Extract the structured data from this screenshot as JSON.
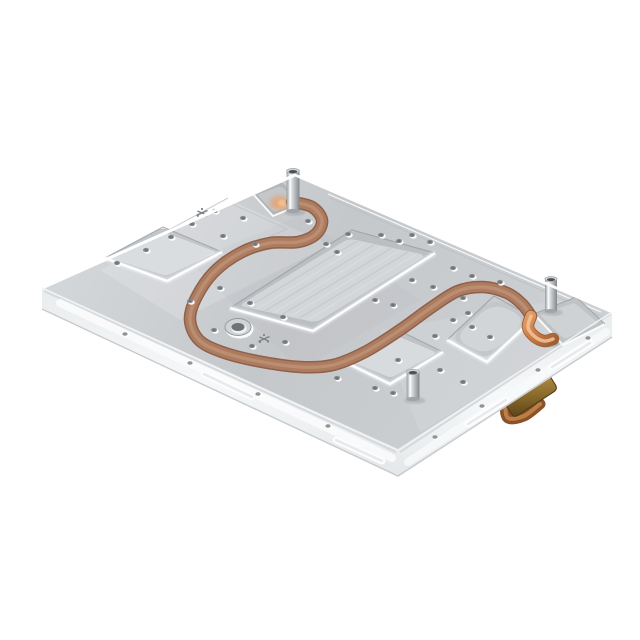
{
  "meta": {
    "type": "product-photograph",
    "subject": "CNC machined aluminum liquid cold plate with embedded serpentine copper tube",
    "background_color": "#ffffff"
  },
  "palette": {
    "bg": "#ffffff",
    "plate_light": "#d6d9dc",
    "plate_mid": "#c6c9cc",
    "plate_edge_hi": "#ffffff",
    "pocket_wall": "#b7bbbe",
    "pocket_floor": "#d7dadc",
    "pocket_rim_dark": "#9ba0a4",
    "wall_light": "#f2f4f5",
    "wall_mid": "#e6e9ea",
    "wall_line": "#cfd3d5",
    "copper_edge": "#8f604a",
    "copper_mid": "#ab7c60",
    "copper_hi": "#c met"
  },
  "palette_fix": {
    "copper_hi": "#c09175",
    "copper_bright": "#cf8048",
    "copper_glow": "#f0b483",
    "brass_dark": "#5e4619",
    "brass_mid": "#9a7b3a",
    "brass_light": "#c4a05c",
    "steel_dark": "#8f9396",
    "steel_light": "#eef0f1",
    "hole_dark": "#878c90",
    "hole_core": "#6f7478",
    "shadow": "#8d9296"
  },
  "scene": {
    "canvas": {
      "w": 640,
      "h": 640
    },
    "plate": {
      "top": [
        [
          42,
          288
        ],
        [
          295,
          175
        ],
        [
          612,
          312
        ],
        [
          398,
          450
        ]
      ],
      "left_wall": [
        [
          42,
          288
        ],
        [
          398,
          450
        ],
        [
          398,
          477
        ],
        [
          42,
          309
        ]
      ],
      "right_wall": [
        [
          398,
          450
        ],
        [
          612,
          312
        ],
        [
          612,
          338
        ],
        [
          398,
          477
        ]
      ]
    },
    "sheens": [
      {
        "pts": [
          [
            100,
            270
          ],
          [
            230,
            200
          ],
          [
            330,
            245
          ],
          [
            180,
            320
          ]
        ],
        "fill": "#ffffff",
        "op": 0.16
      },
      {
        "pts": [
          [
            380,
            330
          ],
          [
            560,
            300
          ],
          [
            600,
            322
          ],
          [
            420,
            432
          ]
        ],
        "fill": "#ffffff",
        "op": 0.1
      },
      {
        "pts": [
          [
            190,
            262
          ],
          [
            300,
            216
          ],
          [
            420,
            300
          ],
          [
            300,
            370
          ]
        ],
        "fill": "#9aa0a5",
        "op": 0.07
      }
    ],
    "pockets": {
      "left": {
        "quad": [
          [
            105,
            258
          ],
          [
            163,
            227
          ],
          [
            222,
            252
          ],
          [
            167,
            281
          ]
        ],
        "r": 7,
        "inset": 5
      },
      "center": {
        "quad": [
          [
            230,
            308
          ],
          [
            352,
            230
          ],
          [
            435,
            253
          ],
          [
            313,
            331
          ]
        ],
        "r": 10,
        "inset": 9,
        "brush": 8
      },
      "small": {
        "quad": [
          [
            345,
            362
          ],
          [
            398,
            330
          ],
          [
            443,
            352
          ],
          [
            390,
            384
          ]
        ],
        "r": 8,
        "inset": 6
      },
      "round_right": {
        "quad": [
          [
            447,
            340
          ],
          [
            494,
            296
          ],
          [
            534,
            318
          ],
          [
            487,
            362
          ]
        ],
        "r": 21,
        "inset": 6
      }
    },
    "notch_top": {
      "quad": [
        [
          253,
          194
        ],
        [
          282,
          182
        ],
        [
          302,
          204
        ],
        [
          273,
          216
        ]
      ],
      "glow": [
        280,
        203
      ]
    },
    "corner_cutout": {
      "quad": [
        [
          534,
          314
        ],
        [
          576,
          297
        ],
        [
          605,
          324
        ],
        [
          563,
          345
        ]
      ]
    },
    "tube": {
      "width": 10.5,
      "path": [
        [
          292,
          202
        ],
        [
          312,
          207
        ],
        [
          322,
          220
        ],
        [
          316,
          234
        ],
        [
          298,
          242
        ],
        [
          270,
          243
        ],
        [
          242,
          252
        ],
        [
          214,
          272
        ],
        [
          196,
          298
        ],
        [
          190,
          320
        ],
        [
          199,
          340
        ],
        [
          222,
          352
        ],
        [
          257,
          361
        ],
        [
          300,
          367
        ],
        [
          333,
          365
        ],
        [
          365,
          352
        ],
        [
          400,
          330
        ],
        [
          432,
          307
        ],
        [
          458,
          291
        ],
        [
          483,
          287
        ],
        [
          507,
          293
        ],
        [
          522,
          304
        ],
        [
          531,
          316
        ]
      ],
      "elbow": [
        [
          531,
          316
        ],
        [
          528,
          327
        ],
        [
          534,
          336
        ],
        [
          544,
          341
        ],
        [
          553,
          339
        ]
      ]
    },
    "counterbore": {
      "cx": 238,
      "cy": 327,
      "rx": 13,
      "ry": 8.5,
      "hole_rx": 6.5,
      "hole_ry": 4
    },
    "fiducials": [
      [
        202,
        213
      ],
      [
        264,
        339
      ]
    ],
    "standoffs": [
      {
        "x": 293,
        "top": 171,
        "h": 40,
        "w": 13
      },
      {
        "x": 551,
        "top": 279,
        "h": 32,
        "w": 12
      },
      {
        "x": 413,
        "top": 372,
        "h": 27,
        "w": 13
      }
    ],
    "holes": [
      [
        215,
        211
      ],
      [
        243,
        218
      ],
      [
        192,
        224
      ],
      [
        171,
        237
      ],
      [
        146,
        250
      ],
      [
        117,
        263
      ],
      [
        223,
        236
      ],
      [
        255,
        244
      ],
      [
        308,
        221
      ],
      [
        326,
        244
      ],
      [
        337,
        252
      ],
      [
        348,
        234
      ],
      [
        220,
        288
      ],
      [
        190,
        301
      ],
      [
        250,
        303
      ],
      [
        283,
        317
      ],
      [
        214,
        330
      ],
      [
        252,
        346
      ],
      [
        285,
        342
      ],
      [
        381,
        235
      ],
      [
        399,
        241
      ],
      [
        412,
        235
      ],
      [
        430,
        242
      ],
      [
        453,
        268
      ],
      [
        472,
        276
      ],
      [
        500,
        282
      ],
      [
        412,
        280
      ],
      [
        433,
        287
      ],
      [
        463,
        298
      ],
      [
        453,
        320
      ],
      [
        472,
        327
      ],
      [
        435,
        336
      ],
      [
        375,
        300
      ],
      [
        393,
        305
      ],
      [
        398,
        360
      ],
      [
        337,
        378
      ],
      [
        375,
        388
      ],
      [
        393,
        393
      ],
      [
        440,
        370
      ],
      [
        463,
        382
      ],
      [
        468,
        313
      ],
      [
        490,
        337
      ]
    ],
    "wall_holes_left": [
      [
        125,
        334
      ],
      [
        190,
        363
      ],
      [
        258,
        394
      ],
      [
        328,
        426
      ]
    ],
    "wall_holes_right": [
      [
        435,
        437
      ],
      [
        482,
        406
      ],
      [
        538,
        370
      ],
      [
        588,
        338
      ]
    ],
    "wall_slots": [
      [
        [
          204,
          374
        ],
        [
          252,
          397
        ]
      ],
      [
        [
          336,
          440
        ],
        [
          382,
          461
        ]
      ],
      [
        [
          468,
          424
        ],
        [
          506,
          400
        ]
      ],
      [
        [
          552,
          367
        ],
        [
          590,
          343
        ]
      ]
    ],
    "wall_bands": {
      "left_hi": [
        [
          60,
          303
        ],
        [
          392,
          458
        ]
      ],
      "right_hi": [
        [
          408,
          462
        ],
        [
          606,
          332
        ]
      ],
      "left_top_dark": [
        [
          44,
          291
        ],
        [
          396,
          452
        ]
      ],
      "right_top_dark": [
        [
          400,
          452
        ],
        [
          610,
          314
        ]
      ],
      "left_bottom": [
        [
          42,
          309
        ],
        [
          398,
          476
        ]
      ],
      "right_bottom": [
        [
          398,
          476
        ],
        [
          612,
          337
        ]
      ]
    },
    "steps": {
      "lineA": [
        [
          128,
          252
        ],
        [
          228,
          198
        ]
      ],
      "quadB": [
        [
          168,
          231
        ],
        [
          232,
          204
        ],
        [
          287,
          229
        ],
        [
          223,
          257
        ]
      ],
      "rim": [
        [
          330,
          198
        ],
        [
          603,
          317
        ]
      ],
      "rim_hi": [
        [
          328,
          194
        ],
        [
          601,
          312
        ]
      ]
    },
    "brass_fitting": {
      "block": [
        [
          504,
          402
        ],
        [
          548,
          373
        ],
        [
          558,
          389
        ],
        [
          514,
          418
        ]
      ],
      "pipe": [
        [
          505,
          404
        ],
        [
          508,
          418
        ],
        [
          524,
          416
        ],
        [
          540,
          404
        ]
      ]
    }
  }
}
